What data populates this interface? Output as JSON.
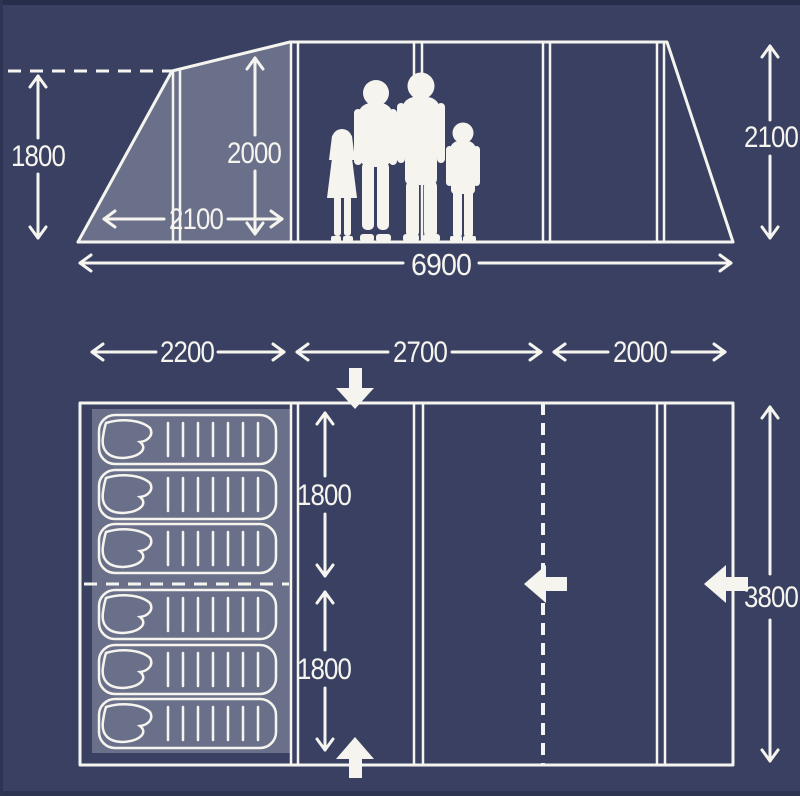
{
  "title": "tent-dimensions-diagram",
  "colors": {
    "background": "#394062",
    "line": "#f5f4ee",
    "shaded_area": "rgba(255,255,255,0.25)"
  },
  "side_view": {
    "front_height": "1800",
    "inner_height": "2000",
    "porch_depth": "2100",
    "rear_height": "2100",
    "length": "6900"
  },
  "floor_plan": {
    "front_width": "2200",
    "middle_width": "2700",
    "rear_width": "2000",
    "bedroom_depth_top": "1800",
    "bedroom_depth_bottom": "1800",
    "total_width": "3800",
    "sleeping_bag_count": 6
  }
}
